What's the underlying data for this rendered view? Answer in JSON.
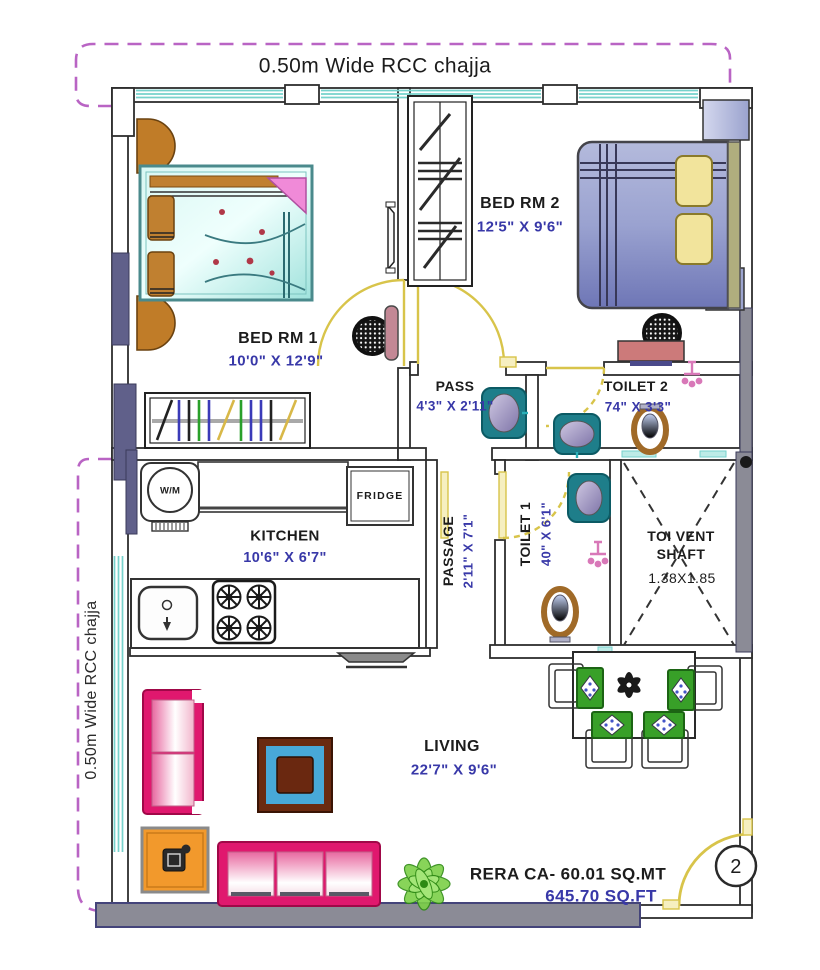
{
  "title_annotations": {
    "chajja_top": "0.50m Wide RCC chajja",
    "chajja_left": "0.50m Wide RCC chajja"
  },
  "rooms": {
    "bed_rm_1": {
      "name": "BED RM 1",
      "dims": "10'0\" X 12'9\""
    },
    "bed_rm_2": {
      "name": "BED RM 2",
      "dims": "12'5\" X 9'6\""
    },
    "pass": {
      "name": "PASS",
      "dims": "4'3\" X 2'11\""
    },
    "toilet_2": {
      "name": "TOILET 2",
      "dims": "74\" X 3'3\""
    },
    "kitchen": {
      "name": "KITCHEN",
      "dims": "10'6\" X 6'7\""
    },
    "passage": {
      "name": "PASSAGE",
      "dims": "2'11\" X 7'1\""
    },
    "toilet_1": {
      "name": "TOILET 1",
      "dims": "40\" X 6'1\""
    },
    "toi_vent_shaft": {
      "name_line1": "TOI VENT",
      "name_line2": "SHAFT",
      "dims": "1.38X1.85"
    },
    "living": {
      "name": "LIVING",
      "dims": "22'7\" X 9'6\""
    }
  },
  "appliances": {
    "washing_machine": "W/M",
    "fridge": "FRIDGE"
  },
  "area": {
    "rera_carpet_area": "RERA CA- 60.01  SQ.MT",
    "carpet_area_sqft": "645.70 SQ.FT"
  },
  "unit_number": "2",
  "colors": {
    "dimension_text": "#3838a8",
    "label_text": "#1c1c1c",
    "door_swing": "#ddc94e",
    "window_glazing": "#76d2cc",
    "chajja_dash": "#b964c4",
    "sofa_pink": "#e0186e",
    "wall_gray": "#8b8b96"
  }
}
